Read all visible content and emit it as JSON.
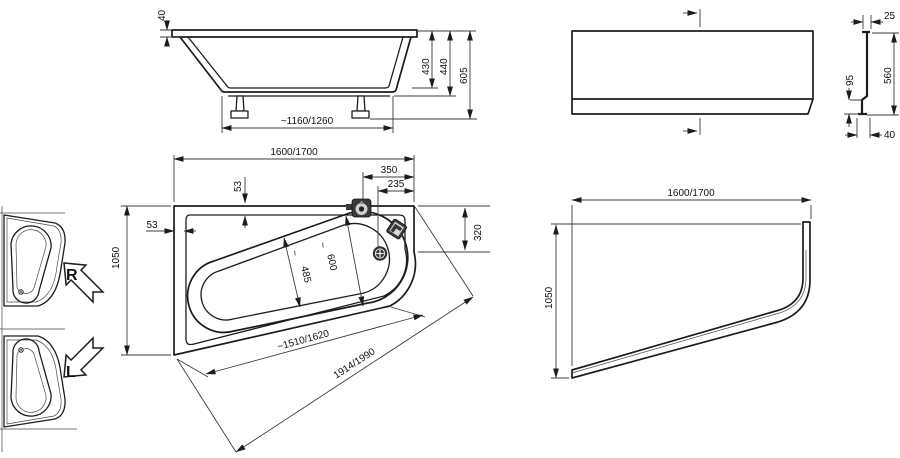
{
  "drawing_title": "asymmetric-bathtub-technical-drawing",
  "side_view": {
    "labels": {
      "rim_thickness": "40",
      "inner_depth": "430",
      "body_height": "440",
      "total_height": "605",
      "feet_spacing": "~1160/1260"
    }
  },
  "panel_profile": {
    "labels": {
      "top_depth": "25",
      "step_height": "95",
      "panel_height": "560",
      "bottom_depth": "40"
    }
  },
  "plan_view": {
    "labels": {
      "overall_length": "1600/1700",
      "tap_offset": "350",
      "drain_offset": "235",
      "rim_width_top": "53",
      "rim_width_left": "53",
      "overall_width": "1050",
      "corner_edge": "320",
      "inner_width_small": "485",
      "inner_width_large": "600",
      "approx_mark": "~",
      "front_inner_length": "~1510/1620",
      "front_edge_length": "1914/1990"
    }
  },
  "panel_plan": {
    "labels": {
      "length": "1600/1700",
      "width": "1050"
    }
  },
  "orientation": {
    "right_label": "R",
    "left_label": "L"
  }
}
